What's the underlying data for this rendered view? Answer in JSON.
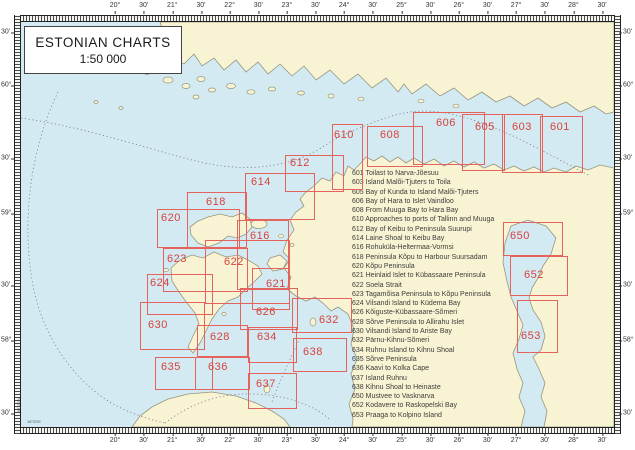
{
  "title": {
    "line1": "ESTONIAN CHARTS",
    "line2": "1:50 000"
  },
  "axis": {
    "top": [
      "20°",
      "30'",
      "21°",
      "30'",
      "22°",
      "30'",
      "23°",
      "30'",
      "24°",
      "30'",
      "25°",
      "30'",
      "26°",
      "30'",
      "27°",
      "30'",
      "28°",
      "30'"
    ],
    "bottom": [
      "20°",
      "30'",
      "21°",
      "30'",
      "22°",
      "30'",
      "23°",
      "30'",
      "24°",
      "30'",
      "25°",
      "30'",
      "26°",
      "30'",
      "27°",
      "30'",
      "28°",
      "30'"
    ],
    "left": [
      "30'",
      "60°",
      "30'",
      "59°",
      "30'",
      "58°",
      "30'"
    ],
    "right": [
      "30'",
      "60°",
      "30'",
      "59°",
      "30'",
      "58°",
      "30'"
    ]
  },
  "corner_notes": {
    "vertical": "57°20'N",
    "horizontal": "18°20'E"
  },
  "legend": [
    {
      "no": "601",
      "title": "Toilast to Narva-Jõesuu"
    },
    {
      "no": "603",
      "title": "Island Malõi-Tjuters to Toila"
    },
    {
      "no": "605",
      "title": "Bay of Kunda to Island Malõi-Tjuters"
    },
    {
      "no": "606",
      "title": "Bay of Hara to Islet Vaindloo"
    },
    {
      "no": "608",
      "title": "From Muuga Bay to Hara Bay"
    },
    {
      "no": "610",
      "title": "Approaches to ports of Tallinn and Muuga"
    },
    {
      "no": "612",
      "title": "Bay of Keibu to Peninsula Suurupi"
    },
    {
      "no": "614",
      "title": "Laine Shoal to Keibu Bay"
    },
    {
      "no": "616",
      "title": "Rohuküla-Heltermaa-Vormsi"
    },
    {
      "no": "618",
      "title": "Peninsula Kõpu to Harbour Suursadam"
    },
    {
      "no": "620",
      "title": "Kõpu Peninsula"
    },
    {
      "no": "621",
      "title": "Heinlaid Islet to Kübassaare Peninsula"
    },
    {
      "no": "622",
      "title": "Soela Strait"
    },
    {
      "no": "623",
      "title": "Tagamõisa Peninsula to Kõpu Peninsula"
    },
    {
      "no": "624",
      "title": "Vilsandi Island to Küdema Bay"
    },
    {
      "no": "626",
      "title": "Kõiguste-Kübassaare-Sõmeri"
    },
    {
      "no": "628",
      "title": "Sõrve Peninsula to Allirahu Islet"
    },
    {
      "no": "630",
      "title": "Vilsandi Island to Ariste Bay"
    },
    {
      "no": "632",
      "title": "Pärnu-Kihnu-Sõmeri"
    },
    {
      "no": "634",
      "title": "Ruhnu Island to Kihnu Shoal"
    },
    {
      "no": "635",
      "title": "Sõrve Peninsula"
    },
    {
      "no": "636",
      "title": "Kaavi to Kolka Cape"
    },
    {
      "no": "637",
      "title": "Island Ruhnu"
    },
    {
      "no": "638",
      "title": "Kihnu Shoal to Heinaste"
    },
    {
      "no": "650",
      "title": "Mustvee to Vasknarva"
    },
    {
      "no": "652",
      "title": "Kodavere to Raskopelski Bay"
    },
    {
      "no": "653",
      "title": "Praaga to Kolpino Island"
    }
  ],
  "boxes": [
    {
      "id": "601",
      "x": 540,
      "y": 116,
      "w": 43,
      "h": 57,
      "lx": 550,
      "ly": 121
    },
    {
      "id": "603",
      "x": 502,
      "y": 114,
      "w": 41,
      "h": 59,
      "lx": 512,
      "ly": 121
    },
    {
      "id": "605",
      "x": 462,
      "y": 114,
      "w": 43,
      "h": 57,
      "lx": 475,
      "ly": 121
    },
    {
      "id": "606",
      "x": 413,
      "y": 112,
      "w": 72,
      "h": 53,
      "lx": 436,
      "ly": 117
    },
    {
      "id": "608",
      "x": 367,
      "y": 126,
      "w": 56,
      "h": 41,
      "lx": 380,
      "ly": 129
    },
    {
      "id": "610",
      "x": 332,
      "y": 124,
      "w": 31,
      "h": 66,
      "lx": 334,
      "ly": 129
    },
    {
      "id": "612",
      "x": 285,
      "y": 155,
      "w": 59,
      "h": 37,
      "lx": 290,
      "ly": 157
    },
    {
      "id": "614",
      "x": 245,
      "y": 173,
      "w": 70,
      "h": 47,
      "lx": 251,
      "ly": 176
    },
    {
      "id": "618",
      "x": 187,
      "y": 192,
      "w": 60,
      "h": 56,
      "lx": 206,
      "ly": 196
    },
    {
      "id": "620",
      "x": 157,
      "y": 209,
      "w": 83,
      "h": 39,
      "lx": 161,
      "ly": 212
    },
    {
      "id": "616",
      "x": 237,
      "y": 220,
      "w": 52,
      "h": 70,
      "lx": 250,
      "ly": 230
    },
    {
      "id": "622",
      "x": 205,
      "y": 240,
      "w": 85,
      "h": 64,
      "lx": 224,
      "ly": 256
    },
    {
      "id": "623",
      "x": 163,
      "y": 248,
      "w": 85,
      "h": 44,
      "lx": 167,
      "ly": 253
    },
    {
      "id": "624",
      "x": 147,
      "y": 274,
      "w": 66,
      "h": 41,
      "lx": 150,
      "ly": 277
    },
    {
      "id": "621",
      "x": 252,
      "y": 268,
      "w": 38,
      "h": 42,
      "lx": 266,
      "ly": 278
    },
    {
      "id": "626",
      "x": 240,
      "y": 288,
      "w": 58,
      "h": 42,
      "lx": 256,
      "ly": 306
    },
    {
      "id": "632",
      "x": 292,
      "y": 298,
      "w": 60,
      "h": 35,
      "lx": 319,
      "ly": 314
    },
    {
      "id": "630",
      "x": 140,
      "y": 302,
      "w": 65,
      "h": 48,
      "lx": 148,
      "ly": 319
    },
    {
      "id": "628",
      "x": 197,
      "y": 325,
      "w": 51,
      "h": 32,
      "lx": 210,
      "ly": 331
    },
    {
      "id": "634",
      "x": 248,
      "y": 327,
      "w": 49,
      "h": 36,
      "lx": 257,
      "ly": 331
    },
    {
      "id": "638",
      "x": 293,
      "y": 338,
      "w": 54,
      "h": 34,
      "lx": 303,
      "ly": 346
    },
    {
      "id": "635",
      "x": 155,
      "y": 357,
      "w": 58,
      "h": 33,
      "lx": 161,
      "ly": 361
    },
    {
      "id": "636",
      "x": 195,
      "y": 357,
      "w": 55,
      "h": 33,
      "lx": 208,
      "ly": 361
    },
    {
      "id": "637",
      "x": 248,
      "y": 373,
      "w": 49,
      "h": 36,
      "lx": 256,
      "ly": 378
    },
    {
      "id": "650",
      "x": 503,
      "y": 222,
      "w": 60,
      "h": 34,
      "lx": 510,
      "ly": 230
    },
    {
      "id": "652",
      "x": 510,
      "y": 256,
      "w": 58,
      "h": 40,
      "lx": 524,
      "ly": 269
    },
    {
      "id": "653",
      "x": 517,
      "y": 300,
      "w": 41,
      "h": 53,
      "lx": 521,
      "ly": 330
    }
  ],
  "colors": {
    "sea": "#d4eaf3",
    "land": "#f8f3d2",
    "coastline": "#96967f",
    "box_border": "#e4635c",
    "box_number": "#d8423c",
    "boundary_line": "#7a7a8a",
    "legend_text": "#3d3d3d"
  }
}
